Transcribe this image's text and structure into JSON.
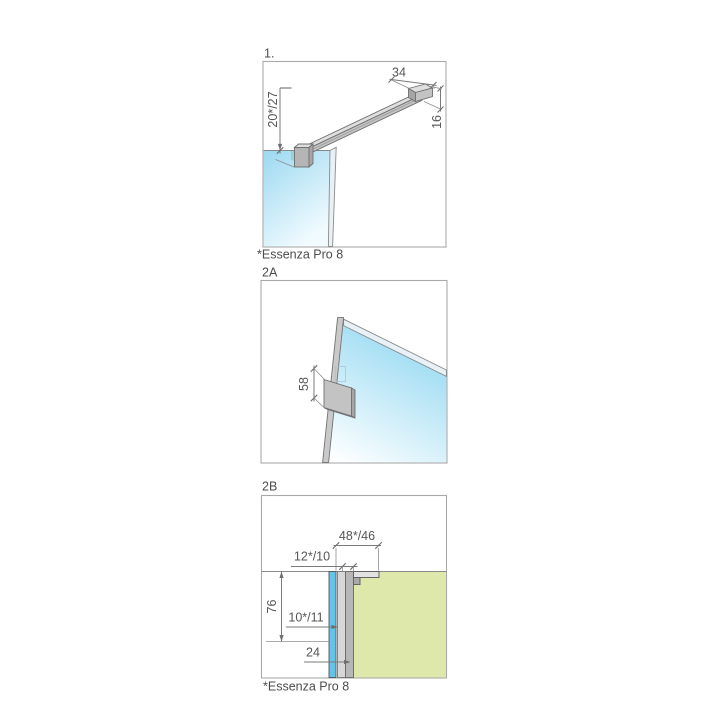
{
  "colors": {
    "glass_strong": "#62c4e9",
    "glass_soft_top": "#9cd9f0",
    "glass_soft_bottom": "#f0faff",
    "glass2a_top": "#96d9f2",
    "glass2a_bottom": "#fdffff",
    "wall_green": "#dde8aa",
    "line_gray": "#7a7a7a",
    "border_gray": "#a9a9a9",
    "text_gray": "#565656"
  },
  "figures": {
    "fig1": {
      "label": "1.",
      "footnote": "*Essenza Pro 8",
      "dims": {
        "top_width": "34",
        "end_height": "16",
        "drop": "20*/27"
      }
    },
    "fig2a": {
      "label": "2A",
      "dims": {
        "plate_height": "58"
      }
    },
    "fig2b": {
      "label": "2B",
      "footnote": "*Essenza Pro 8",
      "dims": {
        "depth": "48*/46",
        "profile_width": "12*/10",
        "height": "76",
        "gap": "10*/11",
        "base_depth": "24"
      }
    }
  }
}
